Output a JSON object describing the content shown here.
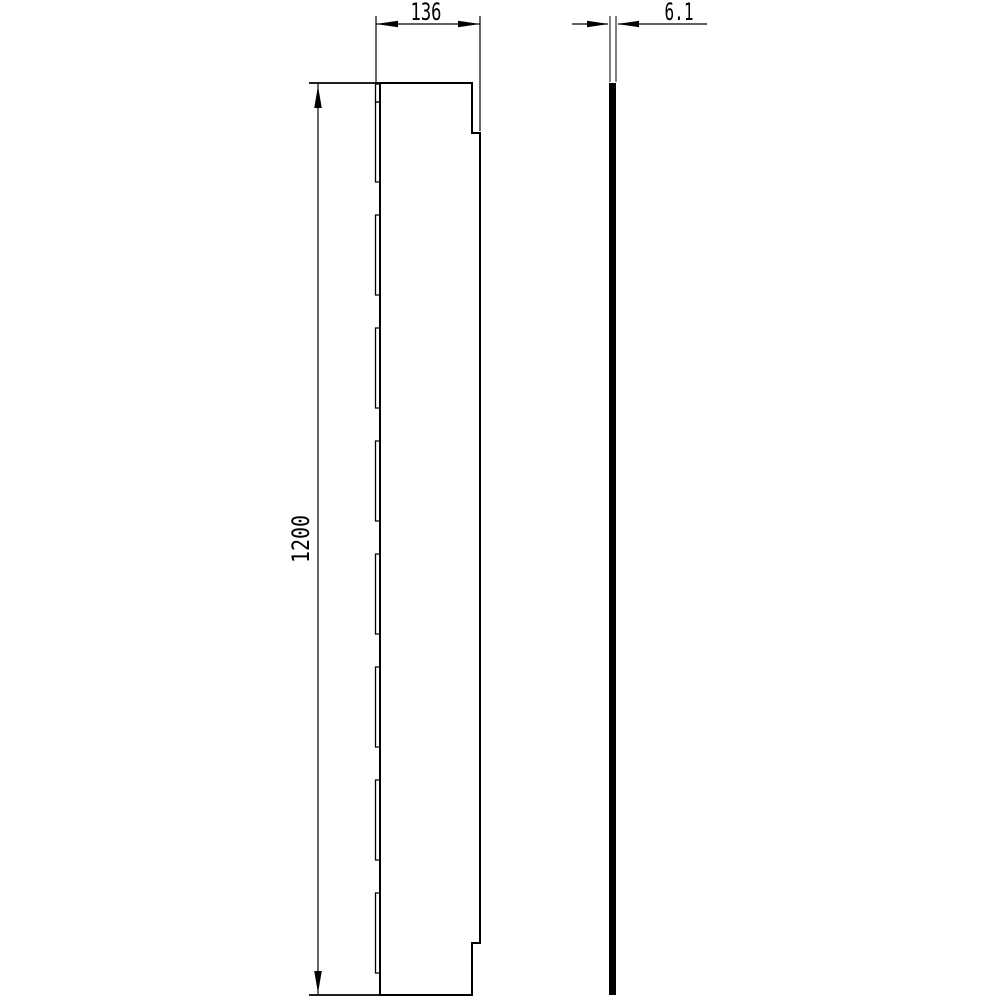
{
  "drawing": {
    "background_color": "#ffffff",
    "line_color": "#000000",
    "views": {
      "front": {
        "width_dimension": "136",
        "height_dimension": "1200"
      },
      "side": {
        "thickness_dimension": "6.1"
      }
    }
  }
}
